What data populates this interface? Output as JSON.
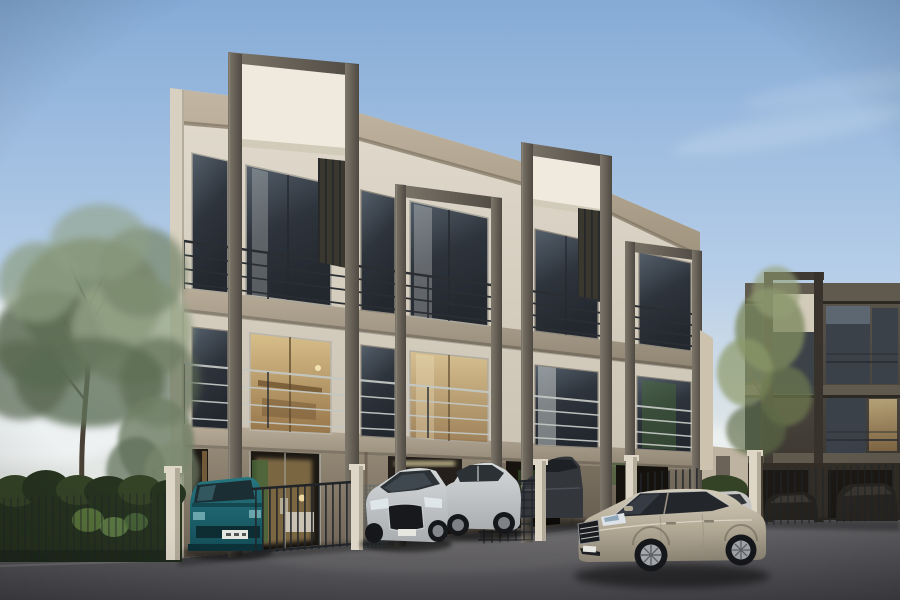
{
  "scene": {
    "type": "architectural-exterior-render",
    "time_of_day": "dusk",
    "description": "Three-storey modern townhome row in beige stucco with dark portal frames and white feature panels above the roofline, balconies with railings, lit interiors, parked cars on an asphalt forecourt, trees and hedge at left, a darker matching building at right.",
    "buildings": {
      "main": {
        "storeys": 3,
        "units_visible": 4,
        "feature": "tall dark portal frames with white sign panels above parapet",
        "wall_color": "#d5cdbd",
        "ground_floor_color": "#84796a"
      },
      "right": {
        "storeys": 3,
        "in_shadow": true,
        "wall_color": "#46413a",
        "feature": "portal frame with light panel"
      }
    },
    "vehicles": [
      {
        "name": "teal-minivan",
        "color": "#267680",
        "position": "far left, front of unit 1"
      },
      {
        "name": "white-coupe",
        "color": "#d6d9da",
        "position": "center, front of unit 2"
      },
      {
        "name": "white-sedan",
        "color": "#d0d3d4",
        "position": "center"
      },
      {
        "name": "gray-car",
        "color": "#33363b",
        "position": "center-right behind gate"
      },
      {
        "name": "background-white-car",
        "color": "#c6c7c4",
        "position": "behind foreground sedan"
      },
      {
        "name": "dark-car-right-1",
        "color": "#26231f",
        "position": "right building forecourt"
      },
      {
        "name": "dark-car-right-2",
        "color": "#2a2722",
        "position": "far right"
      },
      {
        "name": "champagne-sedan",
        "color": "#b2a995",
        "position": "foreground right, three-quarter front view"
      }
    ],
    "vegetation": {
      "left": "large airy tree, small tree, dark clipped hedge",
      "right": "slender tree in front of dark building"
    },
    "sky": "clear blue gradient, warm pale horizon, soft clouds above trees"
  },
  "palette": {
    "sky-top": "#85abd6",
    "sky-mid": "#b5cde8",
    "sky-low": "#dfe6e8",
    "sky-horizon": "#f0ead8",
    "cloud": "#ffffff",
    "facade-light": "#e2dbce",
    "facade-dark": "#c4bcab",
    "parapet-light": "#c3b7a4",
    "parapet-dark": "#a1947f",
    "slab-light": "#b9ad9a",
    "slab-dark": "#8f8472",
    "gf-light": "#948876",
    "gf-dark": "#6e6355",
    "frame-light": "#7d766a",
    "frame-dark": "#4e4942",
    "beam-light": "#8a8274",
    "panel-white": "#efeadd",
    "panel-shade": "#d2cbba",
    "glass-light": "#55606b",
    "glass-dark": "#2e343c",
    "glass-sky": "#9fb0bc",
    "glass-warm": "#d8bf8a",
    "glass-warm-dark": "#97764a",
    "rail-dark": "#2a2e33",
    "rail-light": "#c3c7c3",
    "interior-green": "#466538",
    "interior-warm": "#c9a76b",
    "interior-dark": "#1c1813",
    "bldg2-light": "#5b554b",
    "bldg2-mid": "#46413a",
    "bldg2-dark": "#322e27",
    "bldg2-band": "#5f594e",
    "bldg2-glass": "#3a4149",
    "fence-dark": "#202428",
    "mesh": "#51636a",
    "post-light": "#ded7c8",
    "post-dark": "#b3ab9a",
    "ground-light": "#7d7c7f",
    "ground-mid": "#636266",
    "ground-dark": "#454449",
    "hedge-dark": "#26331f",
    "hedge-mid": "#344326",
    "leaf-bright": "#5f7d40",
    "tree-green": "#77876b",
    "tree-light": "#93a385",
    "tree-dark": "#5a6a52",
    "trunk": "#4a4136",
    "teal-body": "#267680",
    "teal-dark": "#134d57",
    "white-car": "#d6d9da",
    "white-car-shade": "#a9adb0",
    "silver-car": "#d0d3d4",
    "gray-car": "#33363b",
    "champ-light": "#d3ccba",
    "champ-mid": "#b2a995",
    "champ-dark": "#8b8374",
    "tire": "#15171a",
    "rim": "#a4a8ac",
    "plate": "#e6e7e1"
  }
}
